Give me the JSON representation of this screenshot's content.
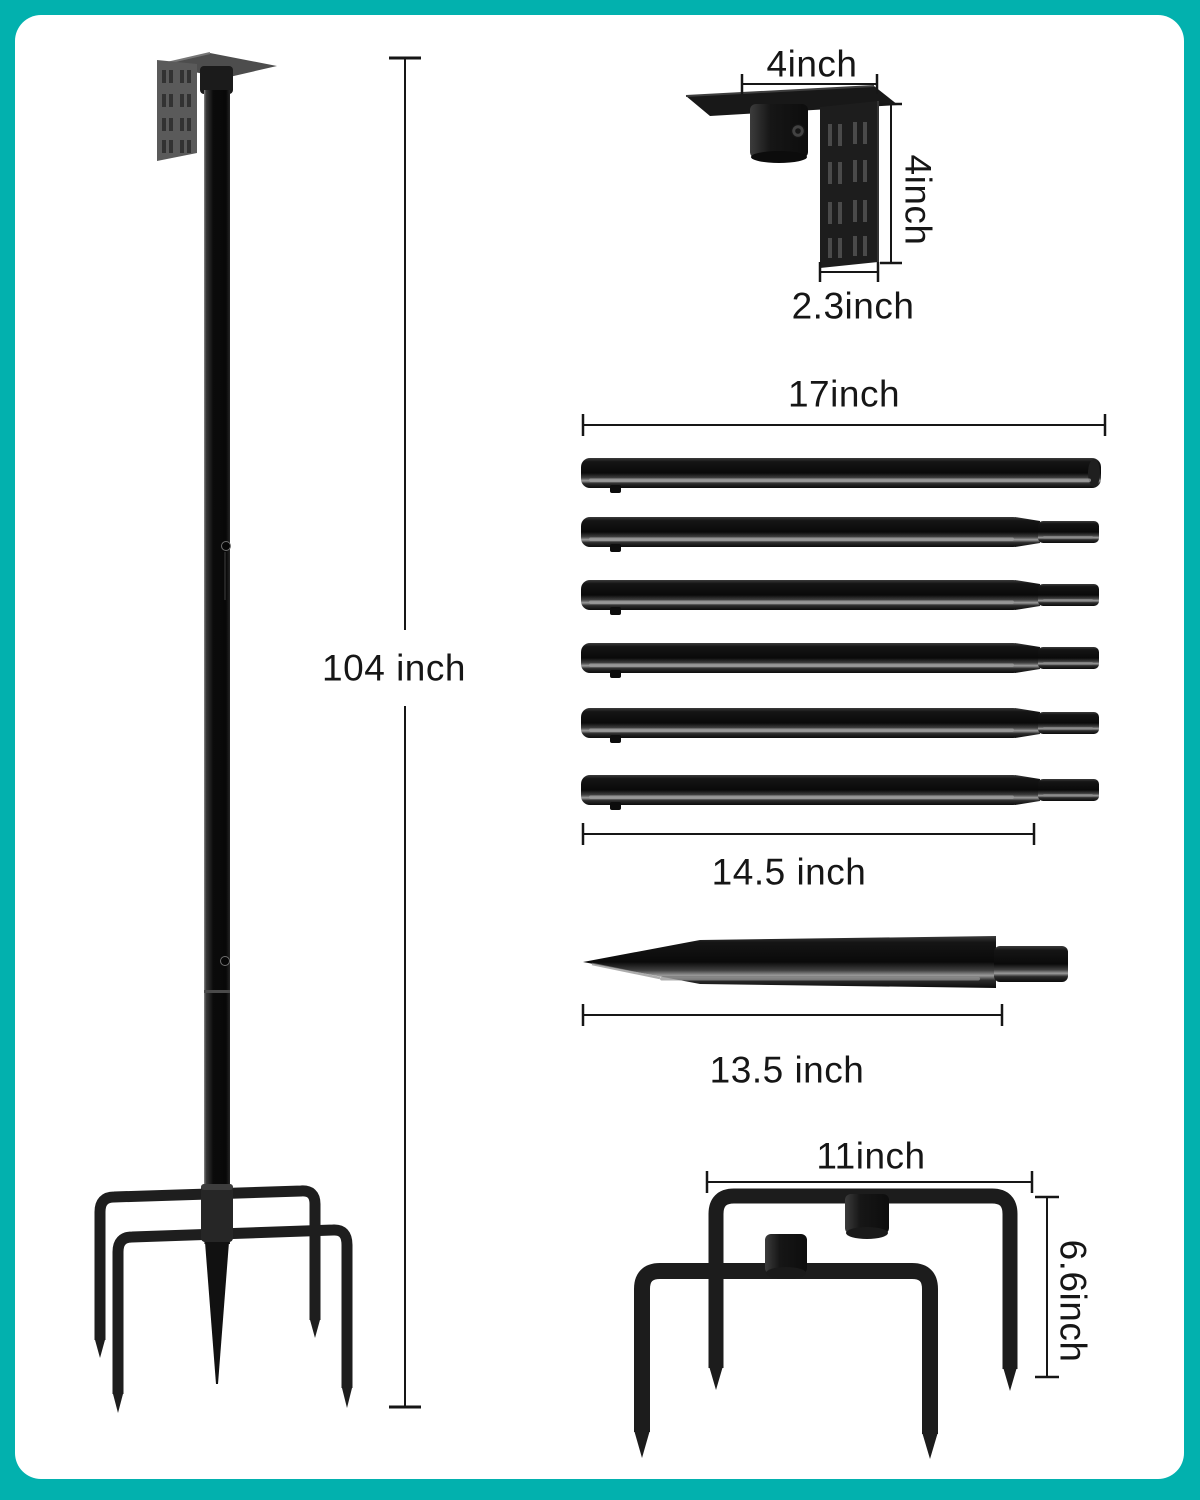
{
  "page": {
    "type": "product-dimension-diagram",
    "product": "adjustable multi-section pole with mounting bracket, ground spike and 5-prong base"
  },
  "theme": {
    "frame_color": "#02b1ae",
    "panel_color": "#ffffff",
    "dimension_line_color": "#161616",
    "product_color": "#0d0d0d",
    "bracket_gray": "#555555"
  },
  "main_pole": {
    "height_label": "104 inch"
  },
  "bracket_detail": {
    "width_label": "4inch",
    "height_label": "4inch",
    "depth_label": "2.3inch"
  },
  "tube_detail": {
    "tube_count": 6,
    "full_length_label": "17inch",
    "body_length_label": "14.5 inch"
  },
  "spike_detail": {
    "length_label": "13.5 inch"
  },
  "base_detail": {
    "width_label": "11inch",
    "height_label": "6.6inch"
  }
}
